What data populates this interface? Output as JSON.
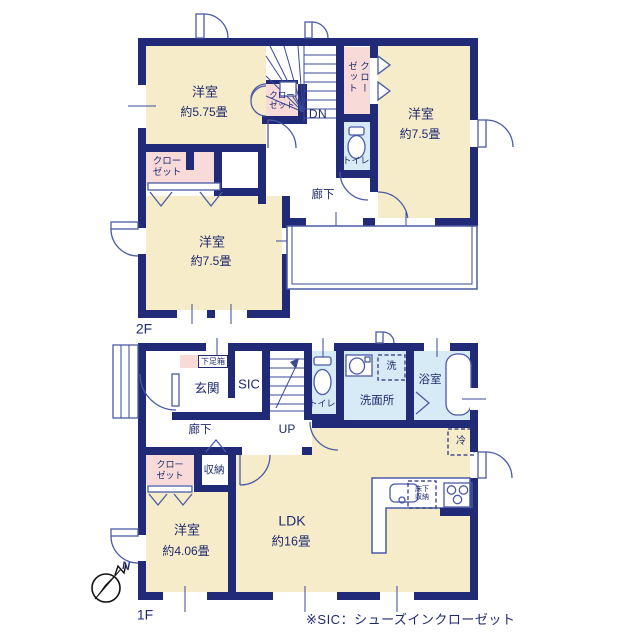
{
  "colors": {
    "wall": "#202a76",
    "room_cream": "#f6ecca",
    "closet_pink": "#f8dbd8",
    "wet_blue": "#d7ebf6",
    "fixture_line": "#4a5aa6",
    "text": "#1f2a6e"
  },
  "floor2": {
    "label": "2F",
    "bedroom_nw": {
      "name": "洋室",
      "size": "約5.75畳"
    },
    "bedroom_e": {
      "name": "洋室",
      "size": "約7.5畳"
    },
    "bedroom_sw": {
      "name": "洋室",
      "size": "約7.5畳"
    },
    "closet_nw": "クロー\nゼット",
    "closet_center": "クローゼット",
    "closet_w": "クロー\nゼット",
    "toilet": "トイレ",
    "hallway": "廊下",
    "stair": "DN"
  },
  "floor1": {
    "label": "1F",
    "entrance": "玄関",
    "shoe_cabinet": "下足箱",
    "sic": "SIC",
    "stair": "UP",
    "toilet": "トイレ",
    "washroom": "洗面所",
    "laundry": "洗",
    "bathroom": "浴室",
    "hallway": "廊下",
    "storage": "収納",
    "closet": "クロー\nゼット",
    "bedroom": {
      "name": "洋室",
      "size": "約4.06畳"
    },
    "ldk": {
      "name": "LDK",
      "size": "約16畳"
    },
    "fridge": "冷",
    "underfloor": "床下\n収納"
  },
  "compass": {
    "label": "N"
  },
  "note": "※SIC：シューズインクローゼット"
}
